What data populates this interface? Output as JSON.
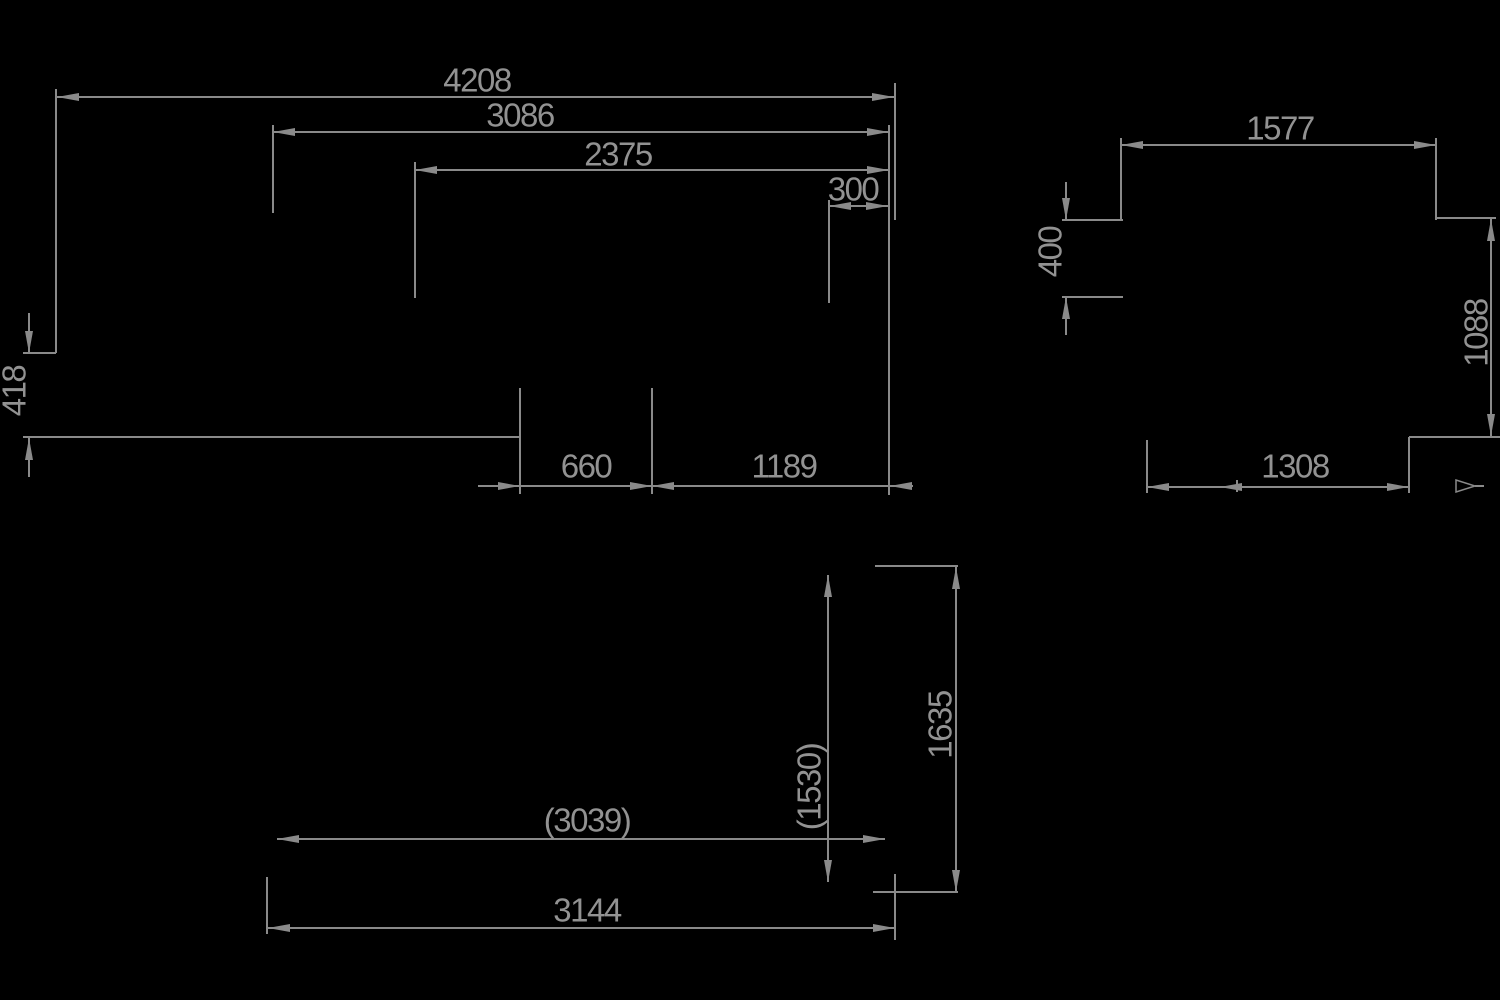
{
  "colors": {
    "background": "#000000",
    "lines": "#8a8a8a",
    "text": "#929292"
  },
  "views": {
    "side_view": {
      "labels": {
        "dim_4208": "4208",
        "dim_3086": "3086",
        "dim_2375": "2375",
        "dim_300": "300",
        "dim_418": "418",
        "dim_660": "660",
        "dim_1189": "1189"
      }
    },
    "rear_view": {
      "labels": {
        "dim_1577": "1577",
        "dim_400": "400",
        "dim_1088": "1088",
        "dim_1308": "1308"
      }
    },
    "top_view": {
      "labels": {
        "dim_1635": "1635",
        "dim_1530": "(1530)",
        "dim_3039": "(3039)",
        "dim_3144": "3144"
      }
    }
  },
  "icons": {
    "view_direction_arrow": "open-triangle-right"
  }
}
